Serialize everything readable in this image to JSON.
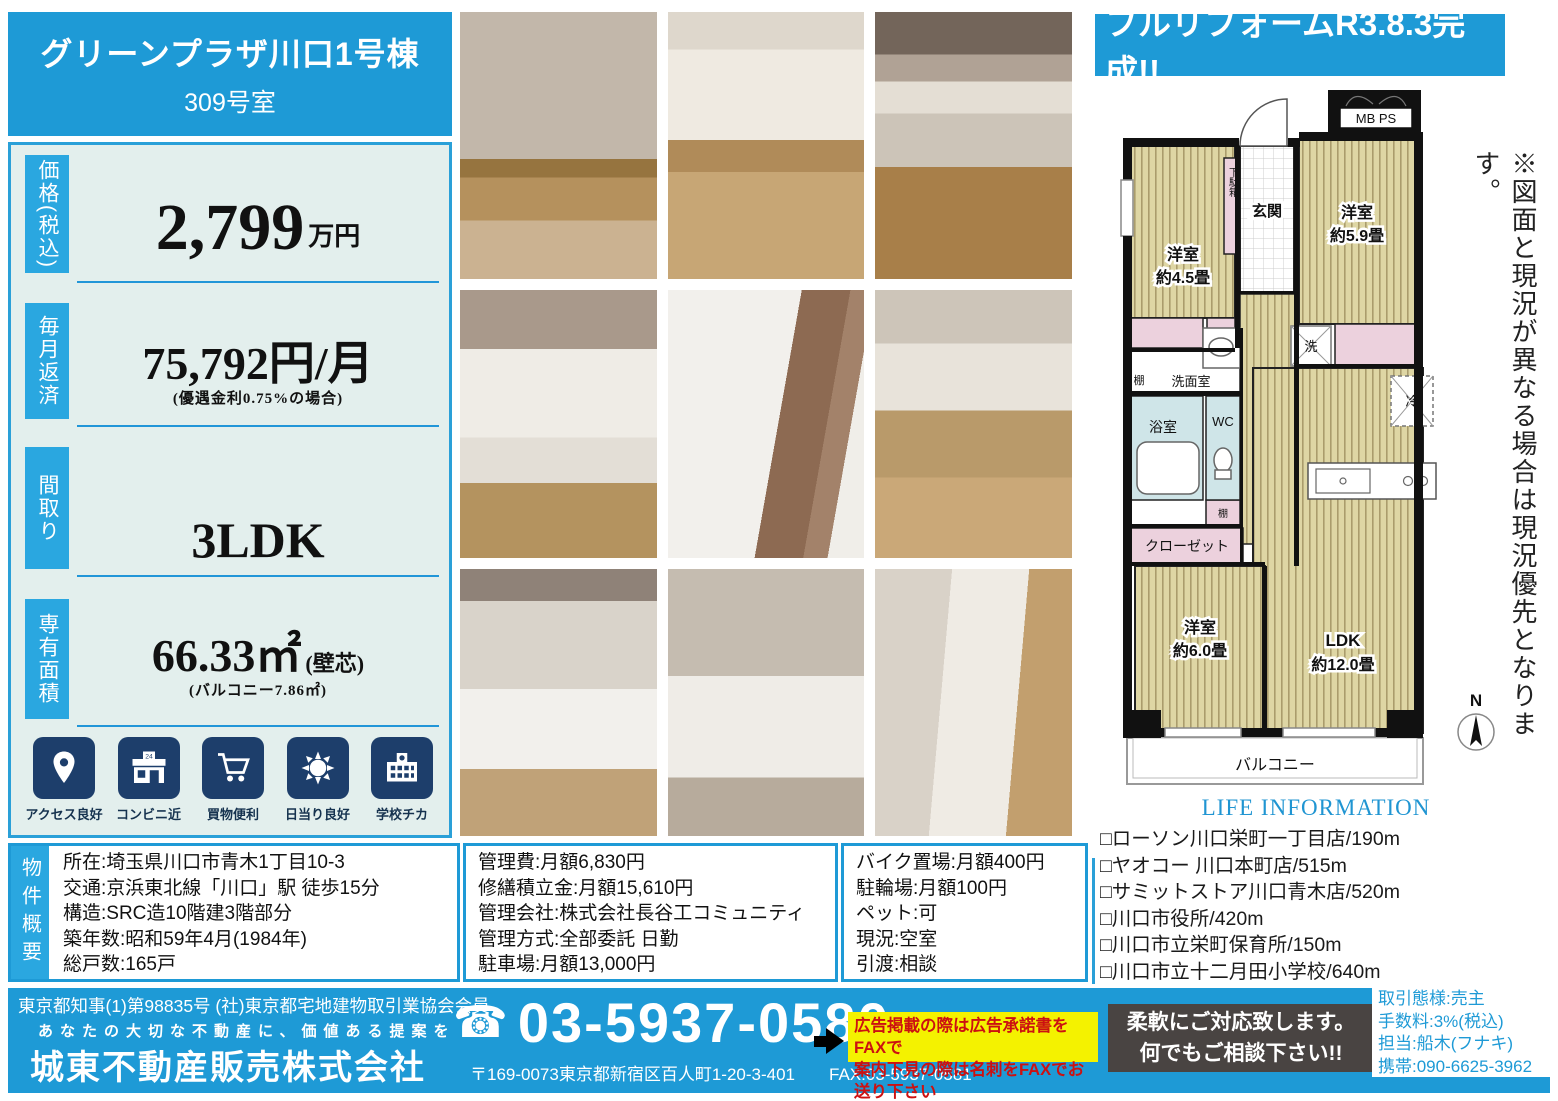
{
  "colors": {
    "primary_blue": "#1e9ad6",
    "tab_blue": "#2aa7e0",
    "icon_navy": "#1d3e6b",
    "panel_bg": "#e3efed",
    "yellow": "#f4f200",
    "alert_red": "#cc1111",
    "dark_box": "#494442"
  },
  "header": {
    "building": "グリーンプラザ川口1号棟",
    "room": "309号室"
  },
  "banner": "フルリフォームR3.8.3完成!!",
  "specs": {
    "price": {
      "label": "価格(税込)",
      "value": "2,799",
      "unit": "万円"
    },
    "monthly": {
      "label": "毎月返済",
      "value": "75,792円/月",
      "note": "(優遇金利0.75%の場合)"
    },
    "layout": {
      "label": "間取り",
      "value": "3LDK"
    },
    "area": {
      "label": "専有面積",
      "value": "66.33㎡",
      "unit": "(壁芯)",
      "note": "(バルコニー7.86㎡)"
    }
  },
  "features": [
    {
      "icon": "location-pin-icon",
      "label": "アクセス良好"
    },
    {
      "icon": "convenience-store-icon",
      "label": "コンビニ近"
    },
    {
      "icon": "shopping-cart-icon",
      "label": "買物便利"
    },
    {
      "icon": "sun-icon",
      "label": "日当り良好"
    },
    {
      "icon": "school-icon",
      "label": "学校チカ"
    }
  ],
  "floorplan": {
    "mbps": "MB PS",
    "genkan": "玄関",
    "getabako": "下駄箱",
    "room1": "洋室",
    "room1_size": "約4.5畳",
    "room2": "洋室",
    "room2_size": "約5.9畳",
    "room3": "洋室",
    "room3_size": "約6.0畳",
    "ldk": "LDK",
    "ldk_size": "約12.0畳",
    "tana1": "棚",
    "tana2": "棚",
    "tana3": "棚",
    "senmen": "洗面室",
    "bath": "浴室",
    "wc": "WC",
    "closet": "クローゼット",
    "washer": "洗",
    "fridge": "冷",
    "balcony": "バルコニー",
    "compass": "N"
  },
  "vertical_note": "※図面と現況が異なる場合は現況優先となります。",
  "life_information": {
    "title": "LIFE INFORMATION",
    "items": [
      "□ローソン川口栄町一丁目店/190m",
      "□ヤオコー 川口本町店/515m",
      "□サミットストア川口青木店/520m",
      "□川口市役所/420m",
      "□川口市立栄町保育所/150m",
      "□川口市立十二月田小学校/640m"
    ]
  },
  "overview": {
    "label": "物件概要",
    "col1": [
      "所在:埼玉県川口市青木1丁目10-3",
      "交通:京浜東北線「川口」駅 徒歩15分",
      "構造:SRC造10階建3階部分",
      "築年数:昭和59年4月(1984年)",
      "総戸数:165戸"
    ],
    "col2": [
      "管理費:月額6,830円",
      "修繕積立金:月額15,610円",
      "管理会社:株式会社長谷工コミュニティ",
      "管理方式:全部委託 日勤",
      "駐車場:月額13,000円"
    ],
    "col3": [
      "バイク置場:月額400円",
      "駐輪場:月額100円",
      "ペット:可",
      "現況:空室",
      "引渡:相談"
    ]
  },
  "footer": {
    "license": "東京都知事(1)第98835号 (社)東京都宅地建物取引業協会会員",
    "slogan": "あなたの大切な不動産に、価値ある提案を",
    "company": "城東不動産販売株式会社",
    "phone_icon": "☎",
    "phone": "03-5937-0580",
    "address": "〒169-0073東京都新宿区百人町1-20-3-401",
    "fax": "FAX:03-5937-0581",
    "fax_note_line1": "広告掲載の際は広告承諾書をFAXで",
    "fax_note_line2": "案内下見の際は名刺をFAXでお送り下さい",
    "message_line1": "柔軟にご対応致します。",
    "message_line2": "何でもご相談下さい!!",
    "agent_line1": "取引態様:売主",
    "agent_line2": "手数料:3%(税込)",
    "agent_line3": "担当:船木(フナキ)",
    "agent_line4": "携帯:090-6625-3962"
  }
}
